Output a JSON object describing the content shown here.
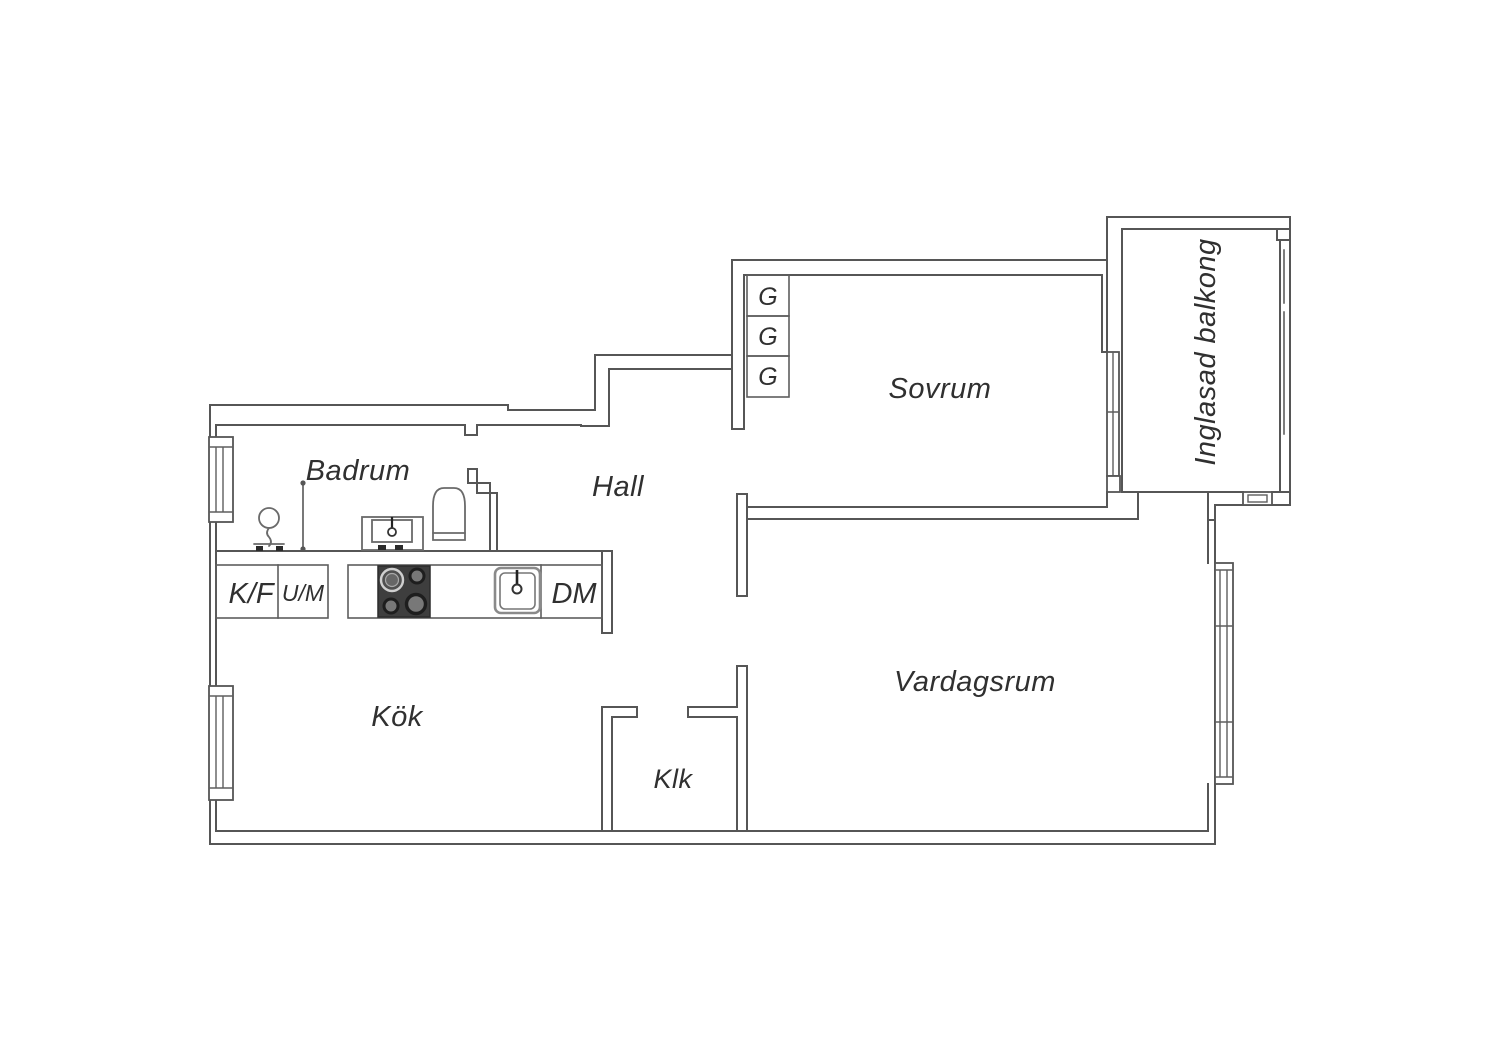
{
  "meta": {
    "type": "apartment-floor-plan",
    "background_color": "#ffffff",
    "wall_color": "#565656",
    "text_color": "#303030",
    "stove_color": "#3e3e3e"
  },
  "rooms": {
    "bathroom": "Badrum",
    "hall": "Hall",
    "bedroom": "Sovrum",
    "kitchen": "Kök",
    "closet": "Klk",
    "living_room": "Vardagsrum",
    "balcony": "Inglasad balkong"
  },
  "fixtures": {
    "fridge_freezer": "K/F",
    "oven_micro": "U/M",
    "dishwasher": "DM",
    "wardrobes": [
      "G",
      "G",
      "G"
    ]
  }
}
